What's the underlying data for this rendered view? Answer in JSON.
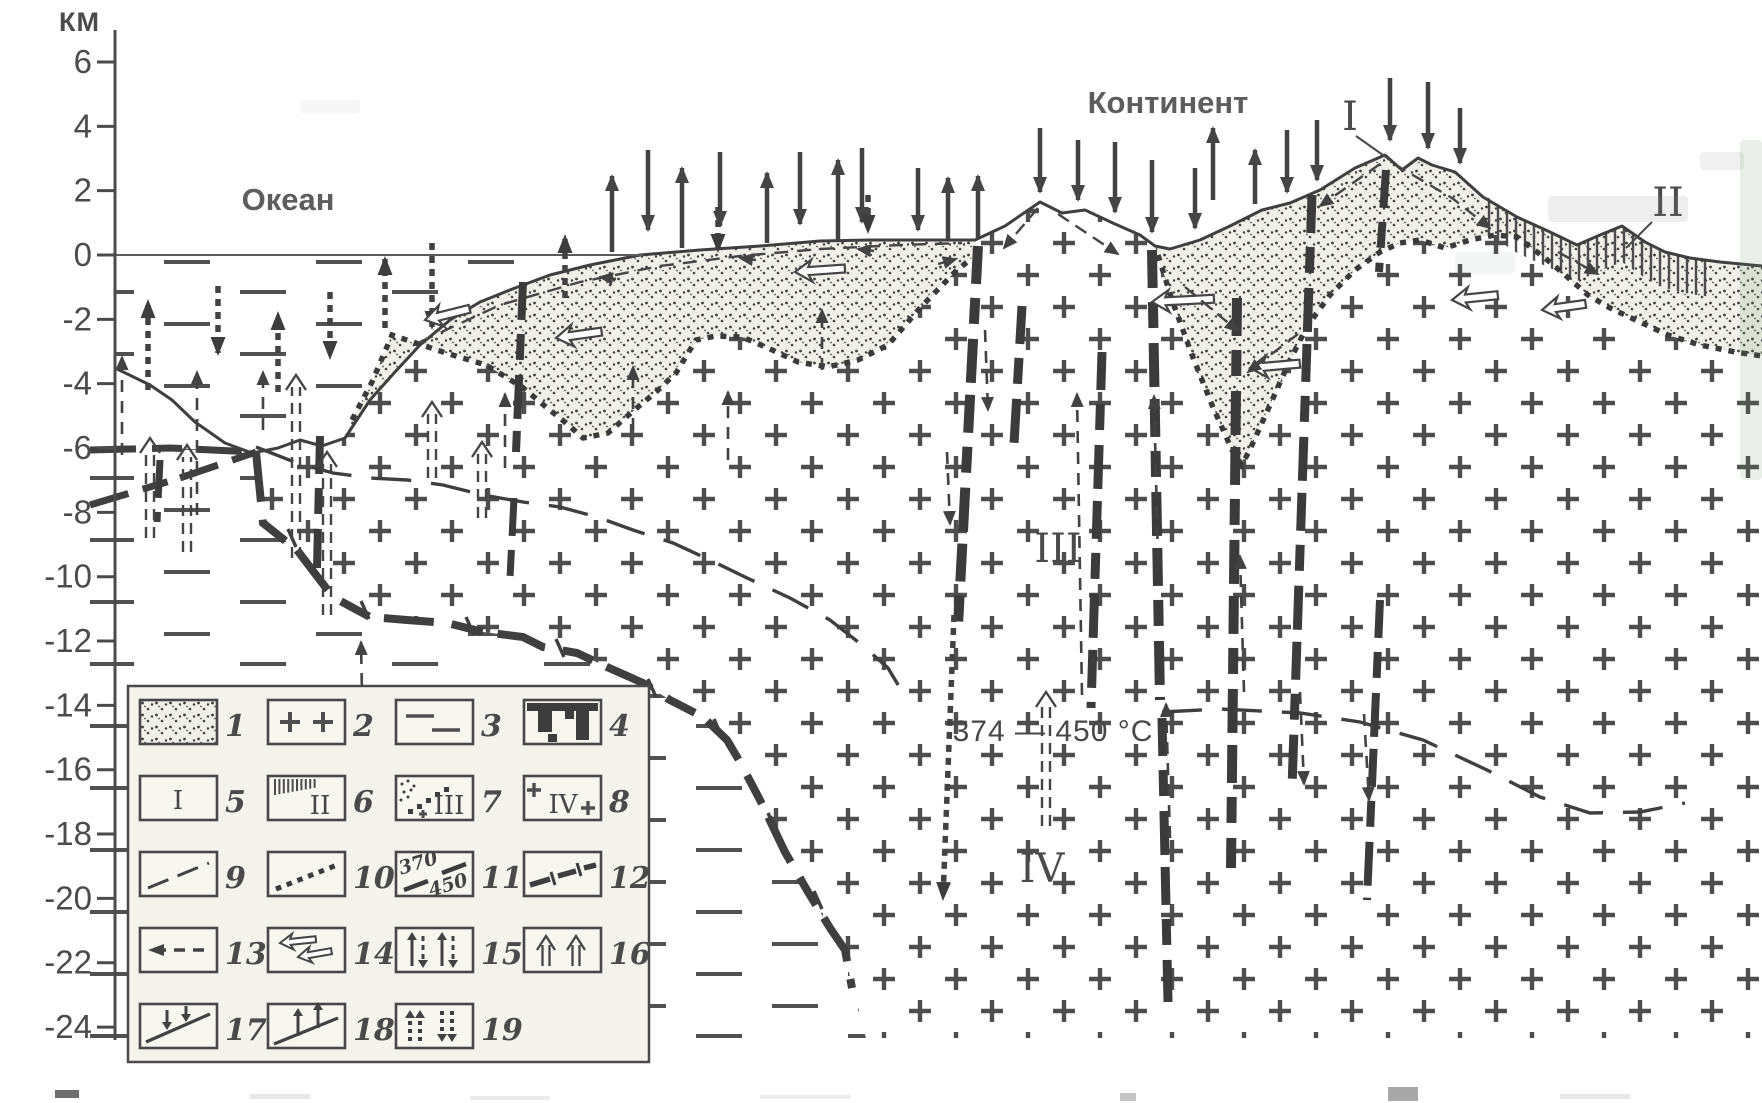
{
  "figure": {
    "axis": {
      "unit": "КМ",
      "ticks": [
        6,
        4,
        2,
        0,
        -2,
        -4,
        -6,
        -8,
        -10,
        -12,
        -14,
        -16,
        -18,
        -20,
        -22,
        -24
      ]
    },
    "labels": {
      "ocean": "Океан",
      "continent": "Континент",
      "isotherm": "374 — 450 °C",
      "zone_peak": "I",
      "zone_margin": "II",
      "zone_crust": "III",
      "zone_deep": "IV"
    },
    "legend": {
      "items": [
        {
          "num": "1",
          "icon": "sediment-stipple"
        },
        {
          "num": "2",
          "icon": "crystalline-plus"
        },
        {
          "num": "3",
          "icon": "fluid-dashes"
        },
        {
          "num": "4",
          "icon": "dike-bodies"
        },
        {
          "num": "5",
          "icon": "zone-roman",
          "roman": "I"
        },
        {
          "num": "6",
          "icon": "zone-roman-hatch",
          "roman": "II"
        },
        {
          "num": "7",
          "icon": "zone-roman-stipple",
          "roman": "III"
        },
        {
          "num": "8",
          "icon": "zone-roman-plus",
          "roman": "IV"
        },
        {
          "num": "9",
          "icon": "dashed-boundary"
        },
        {
          "num": "10",
          "icon": "dotted-boundary"
        },
        {
          "num": "11",
          "icon": "isotherm-line",
          "top_value": "370",
          "bottom_value": "450"
        },
        {
          "num": "12",
          "icon": "thick-dashed-fault"
        },
        {
          "num": "13",
          "icon": "dashed-arrow-left"
        },
        {
          "num": "14",
          "icon": "open-arrows-left"
        },
        {
          "num": "15",
          "icon": "paired-up-down-arrows"
        },
        {
          "num": "16",
          "icon": "double-line-up-arrows"
        },
        {
          "num": "17",
          "icon": "arrows-onto-slope"
        },
        {
          "num": "18",
          "icon": "arrows-off-slope"
        },
        {
          "num": "19",
          "icon": "dotted-up-down-arrows"
        }
      ]
    }
  }
}
